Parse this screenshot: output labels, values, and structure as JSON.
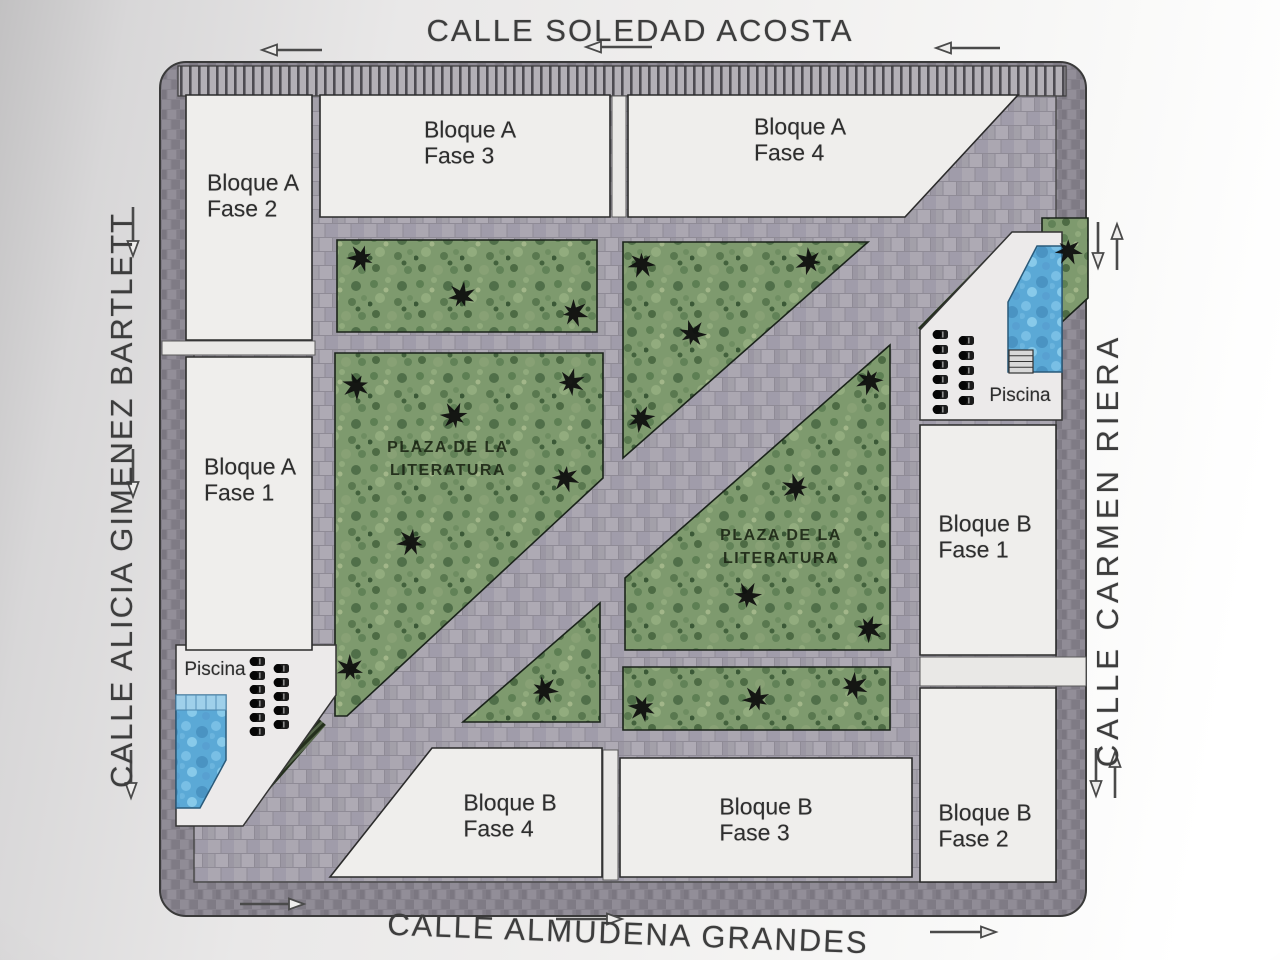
{
  "streets": {
    "top": {
      "name": "CALLE SOLEDAD ACOSTA"
    },
    "bottom": {
      "name": "CALLE ALMUDENA GRANDES"
    },
    "left": {
      "name": "CALLE ALICIA GIMENEZ BARTLETT"
    },
    "right": {
      "name": "CALLE CARMEN RIERA"
    }
  },
  "buildings": [
    {
      "id": "bloque-a-fase-2",
      "line1": "Bloque A",
      "line2": "Fase 2",
      "poly": [
        [
          186,
          95
        ],
        [
          312,
          95
        ],
        [
          312,
          340
        ],
        [
          186,
          340
        ]
      ],
      "label_x": 253,
      "label_y": 196
    },
    {
      "id": "bloque-a-fase-3",
      "line1": "Bloque A",
      "line2": "Fase 3",
      "poly": [
        [
          320,
          95
        ],
        [
          610,
          95
        ],
        [
          610,
          217
        ],
        [
          320,
          217
        ]
      ],
      "label_x": 470,
      "label_y": 143
    },
    {
      "id": "bloque-a-fase-4",
      "line1": "Bloque A",
      "line2": "Fase 4",
      "poly": [
        [
          628,
          95
        ],
        [
          1018,
          95
        ],
        [
          905,
          217
        ],
        [
          628,
          217
        ]
      ],
      "label_x": 800,
      "label_y": 140
    },
    {
      "id": "bloque-a-fase-1",
      "line1": "Bloque A",
      "line2": "Fase 1",
      "poly": [
        [
          186,
          357
        ],
        [
          312,
          357
        ],
        [
          312,
          650
        ],
        [
          186,
          650
        ]
      ],
      "label_x": 250,
      "label_y": 480
    },
    {
      "id": "bloque-b-fase-1",
      "line1": "Bloque B",
      "line2": "Fase 1",
      "poly": [
        [
          920,
          425
        ],
        [
          1056,
          425
        ],
        [
          1056,
          655
        ],
        [
          920,
          655
        ]
      ],
      "label_x": 985,
      "label_y": 537
    },
    {
      "id": "bloque-b-fase-2",
      "line1": "Bloque B",
      "line2": "Fase 2",
      "poly": [
        [
          920,
          688
        ],
        [
          1056,
          688
        ],
        [
          1056,
          882
        ],
        [
          920,
          882
        ]
      ],
      "label_x": 985,
      "label_y": 826
    },
    {
      "id": "bloque-b-fase-3",
      "line1": "Bloque B",
      "line2": "Fase 3",
      "poly": [
        [
          620,
          758
        ],
        [
          912,
          758
        ],
        [
          912,
          877
        ],
        [
          620,
          877
        ]
      ],
      "label_x": 766,
      "label_y": 820
    },
    {
      "id": "bloque-b-fase-4",
      "line1": "Bloque B",
      "line2": "Fase 4",
      "poly": [
        [
          432,
          748
        ],
        [
          602,
          748
        ],
        [
          602,
          877
        ],
        [
          330,
          877
        ]
      ],
      "label_x": 510,
      "label_y": 816
    }
  ],
  "greens": [
    {
      "id": "green-top-left",
      "poly": [
        [
          337,
          240
        ],
        [
          597,
          240
        ],
        [
          597,
          332
        ],
        [
          337,
          332
        ]
      ]
    },
    {
      "id": "green-upper-triangle",
      "poly": [
        [
          623,
          242
        ],
        [
          868,
          242
        ],
        [
          623,
          458
        ]
      ]
    },
    {
      "id": "green-plaza-west",
      "poly": [
        [
          335,
          353
        ],
        [
          603,
          353
        ],
        [
          603,
          478
        ],
        [
          347,
          716
        ],
        [
          335,
          716
        ]
      ]
    },
    {
      "id": "green-small-triangle",
      "poly": [
        [
          600,
          603
        ],
        [
          600,
          722
        ],
        [
          463,
          722
        ]
      ]
    },
    {
      "id": "green-plaza-east",
      "poly": [
        [
          625,
          578
        ],
        [
          890,
          345
        ],
        [
          890,
          650
        ],
        [
          625,
          650
        ]
      ]
    },
    {
      "id": "green-bottom-strip",
      "poly": [
        [
          623,
          667
        ],
        [
          890,
          667
        ],
        [
          890,
          730
        ],
        [
          623,
          730
        ]
      ]
    },
    {
      "id": "green-corner-ne",
      "poly": [
        [
          1042,
          218
        ],
        [
          1088,
          218
        ],
        [
          1088,
          298
        ],
        [
          1062,
          322
        ],
        [
          1042,
          233
        ]
      ]
    }
  ],
  "plazas": [
    {
      "line1": "PLAZA DE LA",
      "line2": "LITERATURA",
      "x": 448,
      "y": 459
    },
    {
      "line1": "PLAZA DE LA",
      "line2": "LITERATURA",
      "x": 781,
      "y": 547
    }
  ],
  "pools": [
    {
      "id": "pool-area-southwest",
      "label": "Piscina",
      "label_x": 215,
      "label_y": 670,
      "platform": [
        [
          176,
          645
        ],
        [
          336,
          645
        ],
        [
          336,
          695
        ],
        [
          243,
          826
        ],
        [
          176,
          826
        ]
      ],
      "water": [
        [
          176,
          695
        ],
        [
          226,
          695
        ],
        [
          226,
          760
        ],
        [
          200,
          808
        ],
        [
          176,
          808
        ]
      ],
      "ledge": {
        "x": 176,
        "y": 695,
        "w": 50,
        "h": 15
      },
      "hedge": [
        [
          243,
          790
        ],
        [
          311,
          712
        ],
        [
          326,
          725
        ],
        [
          258,
          803
        ]
      ],
      "lounger_cols": [
        {
          "x": 251,
          "y": 657,
          "count": 6,
          "step": 14
        },
        {
          "x": 275,
          "y": 664,
          "count": 5,
          "step": 14
        }
      ]
    },
    {
      "id": "pool-area-northeast",
      "label": "Piscina",
      "label_x": 1020,
      "label_y": 396,
      "platform": [
        [
          1012,
          232
        ],
        [
          1062,
          232
        ],
        [
          1062,
          420
        ],
        [
          920,
          420
        ],
        [
          920,
          330
        ]
      ],
      "water": [
        [
          1037,
          246
        ],
        [
          1062,
          246
        ],
        [
          1062,
          372
        ],
        [
          1008,
          372
        ],
        [
          1008,
          302
        ]
      ],
      "steps": {
        "x": 1009,
        "y": 350,
        "w": 24,
        "h": 23
      },
      "hedge": [
        [
          918,
          328
        ],
        [
          1010,
          234
        ],
        [
          1024,
          247
        ],
        [
          932,
          341
        ]
      ],
      "lounger_cols": [
        {
          "x": 934,
          "y": 330,
          "count": 6,
          "step": 15
        },
        {
          "x": 960,
          "y": 336,
          "count": 5,
          "step": 15
        }
      ]
    }
  ],
  "trees": [
    [
      362,
      258
    ],
    [
      462,
      297
    ],
    [
      573,
      313
    ],
    [
      642,
      263
    ],
    [
      810,
      262
    ],
    [
      692,
      335
    ],
    [
      640,
      418
    ],
    [
      357,
      385
    ],
    [
      455,
      417
    ],
    [
      570,
      383
    ],
    [
      565,
      477
    ],
    [
      412,
      542
    ],
    [
      350,
      670
    ],
    [
      543,
      690
    ],
    [
      870,
      380
    ],
    [
      797,
      488
    ],
    [
      747,
      597
    ],
    [
      868,
      628
    ],
    [
      643,
      707
    ],
    [
      757,
      700
    ],
    [
      853,
      687
    ],
    [
      1068,
      250
    ]
  ],
  "paths": [
    {
      "x": 162,
      "y": 341,
      "w": 153,
      "h": 14
    },
    {
      "x": 920,
      "y": 657,
      "w": 166,
      "h": 29
    },
    {
      "x": 612,
      "y": 96,
      "w": 14,
      "h": 121
    },
    {
      "x": 603,
      "y": 750,
      "w": 15,
      "h": 130
    }
  ],
  "arrows": [
    {
      "x1": 322,
      "y1": 50,
      "x2": 262,
      "y2": 50
    },
    {
      "x1": 652,
      "y1": 47,
      "x2": 586,
      "y2": 47
    },
    {
      "x1": 1000,
      "y1": 48,
      "x2": 936,
      "y2": 48
    },
    {
      "x1": 240,
      "y1": 904,
      "x2": 304,
      "y2": 904
    },
    {
      "x1": 556,
      "y1": 919,
      "x2": 622,
      "y2": 919
    },
    {
      "x1": 930,
      "y1": 932,
      "x2": 996,
      "y2": 932
    },
    {
      "x1": 133,
      "y1": 207,
      "x2": 133,
      "y2": 256
    },
    {
      "x1": 133,
      "y1": 449,
      "x2": 133,
      "y2": 497
    },
    {
      "x1": 131,
      "y1": 750,
      "x2": 131,
      "y2": 798
    },
    {
      "x1": 1098,
      "y1": 222,
      "x2": 1098,
      "y2": 268
    },
    {
      "x1": 1117,
      "y1": 270,
      "x2": 1117,
      "y2": 224
    },
    {
      "x1": 1096,
      "y1": 748,
      "x2": 1096,
      "y2": 796
    },
    {
      "x1": 1115,
      "y1": 798,
      "x2": 1115,
      "y2": 752
    }
  ],
  "colors": {
    "sidewalk_ring": "#87838d",
    "courtyard": "#a6a2ac",
    "building": "#efeeec",
    "grass": "#7e9a6e",
    "water": "#5ba9d6",
    "outline": "#2b2b2b",
    "street_text": "#3d3d3d"
  }
}
